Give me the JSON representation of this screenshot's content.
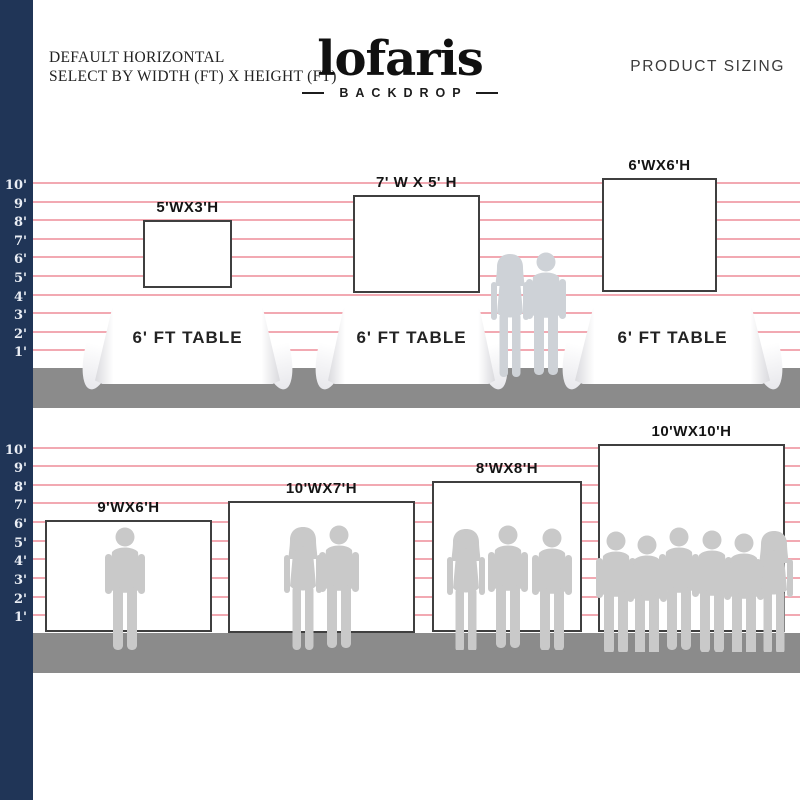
{
  "header": {
    "note_line1": "DEFAULT HORIZONTAL",
    "note_line2": "SELECT BY WIDTH (FT) X HEIGHT (FT)",
    "right_title": "PRODUCT SIZING"
  },
  "brand": {
    "name": "lofaris",
    "subtitle": "BACKDROP"
  },
  "ruler_labels": [
    "10'",
    "9'",
    "8'",
    "7'",
    "6'",
    "5'",
    "4'",
    "3'",
    "2'",
    "1'"
  ],
  "section_top": {
    "backdrops": [
      {
        "label": "5'WX3'H"
      },
      {
        "label": "7' W X 5' H"
      },
      {
        "label": "6'WX6'H"
      }
    ],
    "tables": [
      {
        "label": "6' FT TABLE"
      },
      {
        "label": "6' FT TABLE"
      },
      {
        "label": "6' FT TABLE"
      }
    ]
  },
  "section_bottom": {
    "backdrops": [
      {
        "label": "9'WX6'H"
      },
      {
        "label": "10'WX7'H"
      },
      {
        "label": "8'WX8'H"
      },
      {
        "label": "10'WX10'H"
      }
    ]
  },
  "colors": {
    "navy": "#203557",
    "pink": "#f09aa4",
    "floor": "#8b8b8b",
    "sil": "#c9c9c9",
    "bdr": "#3f3f3f"
  }
}
